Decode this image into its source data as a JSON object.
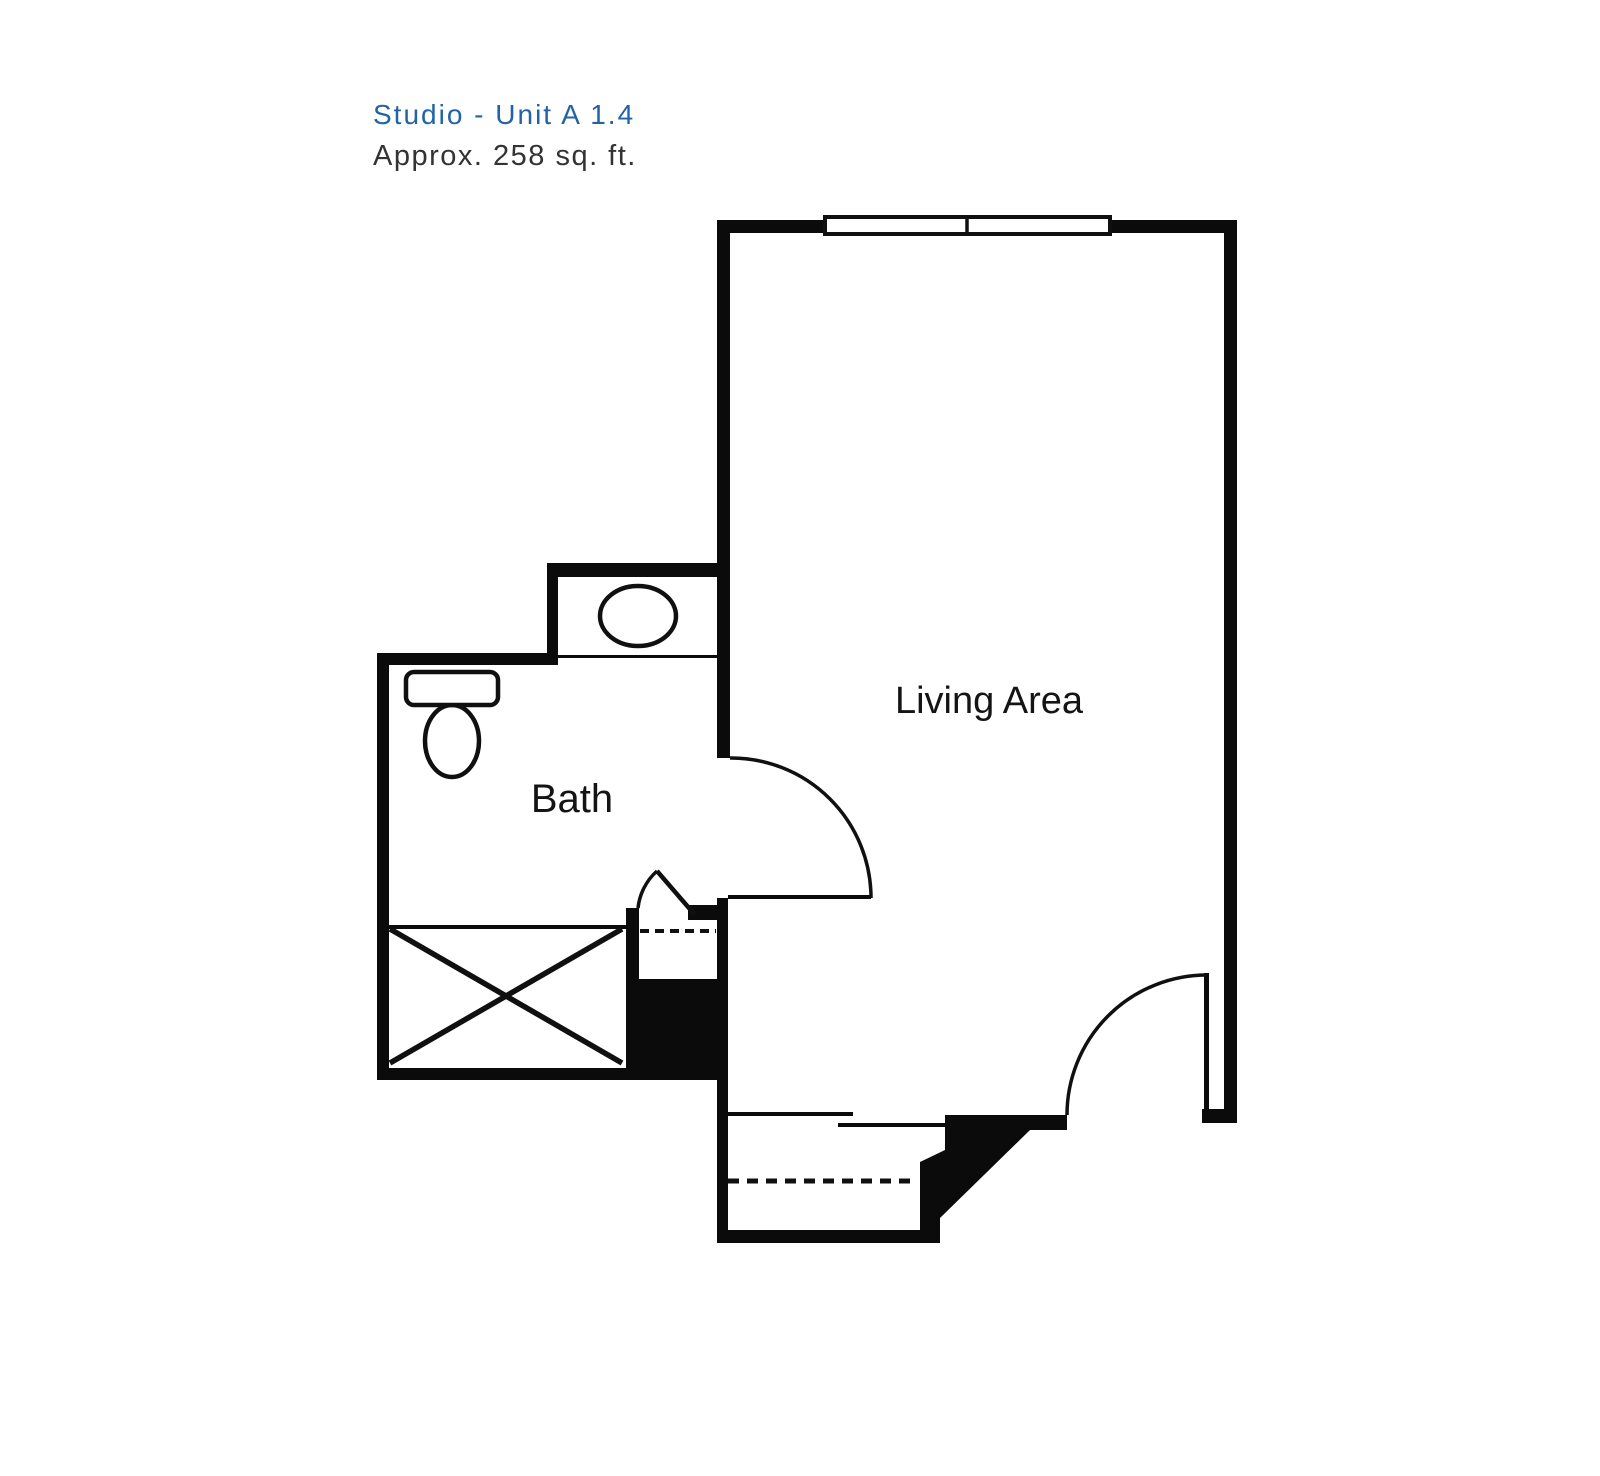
{
  "header": {
    "unit_title": "Studio - Unit A 1.4",
    "area_text": "Approx. 258 sq. ft."
  },
  "floorplan": {
    "rooms": {
      "living": "Living Area",
      "bath": "Bath"
    },
    "colors": {
      "wall": "#0b0b0c",
      "line": "#101010",
      "fixture_fill": "#ffffff",
      "label_text": "#141414",
      "title_blue": "#2263a7",
      "subtitle_gray": "#333333",
      "background": "#ffffff"
    },
    "fixtures": [
      "window",
      "entry-door",
      "living-room-door",
      "bath-door",
      "sink",
      "toilet",
      "shower-tub",
      "closet-shelf-dashed",
      "entry-closet-dashed"
    ]
  }
}
